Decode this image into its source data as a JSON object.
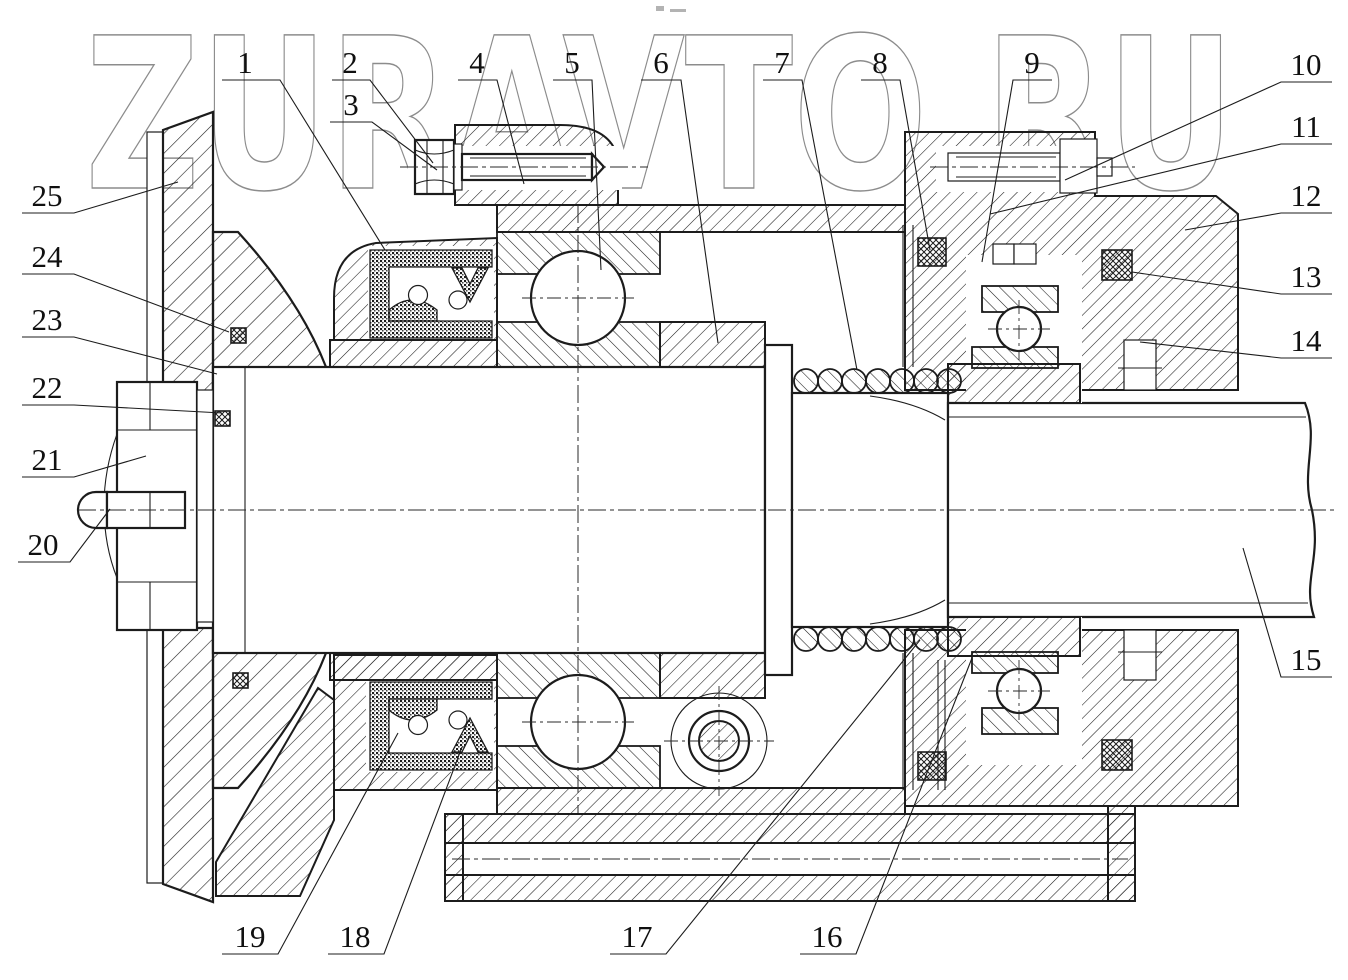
{
  "watermark": {
    "text": "ZURAVTO.RU"
  },
  "colors": {
    "line": "#1c1c1c",
    "watermark": "#8c8c8c",
    "background": "#ffffff"
  },
  "callouts": [
    {
      "label": "1"
    },
    {
      "label": "2"
    },
    {
      "label": "3"
    },
    {
      "label": "4"
    },
    {
      "label": "5"
    },
    {
      "label": "6"
    },
    {
      "label": "7"
    },
    {
      "label": "8"
    },
    {
      "label": "9"
    },
    {
      "label": "10"
    },
    {
      "label": "11"
    },
    {
      "label": "12"
    },
    {
      "label": "13"
    },
    {
      "label": "14"
    },
    {
      "label": "15"
    },
    {
      "label": "16"
    },
    {
      "label": "17"
    },
    {
      "label": "18"
    },
    {
      "label": "19"
    },
    {
      "label": "20"
    },
    {
      "label": "21"
    },
    {
      "label": "22"
    },
    {
      "label": "23"
    },
    {
      "label": "24"
    },
    {
      "label": "25"
    }
  ]
}
